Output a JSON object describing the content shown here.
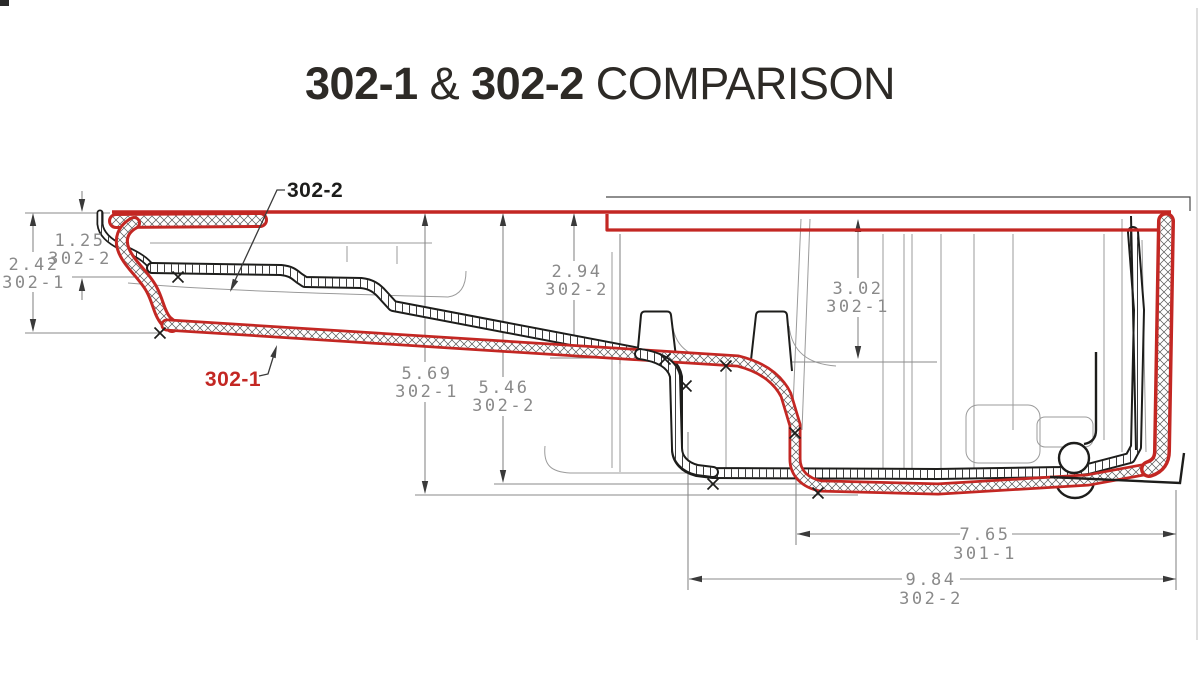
{
  "title": {
    "bold1": "302-1",
    "sep": " & ",
    "bold2": "302-2",
    "tail": " COMPARISON"
  },
  "part_labels": {
    "pan_302_2": "302-2",
    "pan_302_1": "302-1"
  },
  "dims": [
    {
      "value": "1.25",
      "part": "302-2"
    },
    {
      "value": "2.42",
      "part": "302-1"
    },
    {
      "value": "2.94",
      "part": "302-2"
    },
    {
      "value": "3.02",
      "part": "302-1"
    },
    {
      "value": "5.69",
      "part": "302-1"
    },
    {
      "value": "5.46",
      "part": "302-2"
    },
    {
      "value": "7.65",
      "part": "301-1"
    },
    {
      "value": "9.84",
      "part": "302-2"
    }
  ],
  "colors": {
    "red_outline": "#c32723",
    "black_outline": "#1d1d1b",
    "dim_gray": "#8a8a8a",
    "title_dark": "#2d2a26",
    "background": "#ffffff"
  }
}
